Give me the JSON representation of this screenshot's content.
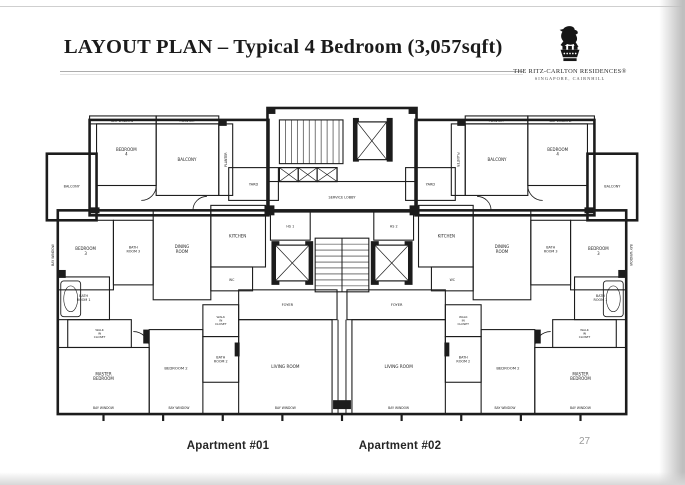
{
  "slide": {
    "title": "LAYOUT PLAN – Typical 4 Bedroom (3,057sqft)",
    "page_number": "27",
    "captions": {
      "apartment1": "Apartment #01",
      "apartment2": "Apartment #02"
    },
    "brand": {
      "logo_icon": "lion-crest",
      "name_display": "THE RITZ-CARLTON RESIDENCES®",
      "location": "SINGAPORE, CAIRNHILL"
    }
  },
  "floorplan": {
    "ink": "#1c1c1c",
    "label_color": "#1d1d1d",
    "rooms": [
      {
        "id": "bay-strip-l",
        "x": 46,
        "y": 10,
        "w": 67,
        "h": 8
      },
      {
        "id": "planter-strip-l",
        "x": 113,
        "y": 10,
        "w": 63,
        "h": 8
      },
      {
        "id": "bedroom4-l",
        "x": 53,
        "y": 18,
        "w": 60,
        "h": 62
      },
      {
        "id": "balcony-top-l",
        "x": 113,
        "y": 18,
        "w": 63,
        "h": 72
      },
      {
        "id": "planter-col-l",
        "x": 176,
        "y": 18,
        "w": 14,
        "h": 72
      },
      {
        "id": "balcony-left",
        "x": 3,
        "y": 48,
        "w": 50,
        "h": 67
      },
      {
        "id": "yard-l",
        "x": 186,
        "y": 62,
        "w": 50,
        "h": 33
      },
      {
        "id": "kitchen-l",
        "x": 168,
        "y": 100,
        "w": 55,
        "h": 62
      },
      {
        "id": "wc-l",
        "x": 168,
        "y": 162,
        "w": 42,
        "h": 24
      },
      {
        "id": "hs-1",
        "x": 228,
        "y": 105,
        "w": 40,
        "h": 30
      },
      {
        "id": "dining-l",
        "x": 110,
        "y": 105,
        "w": 58,
        "h": 90
      },
      {
        "id": "bedroom3-l",
        "x": 14,
        "y": 115,
        "w": 56,
        "h": 70
      },
      {
        "id": "bath3-l",
        "x": 70,
        "y": 115,
        "w": 40,
        "h": 65
      },
      {
        "id": "bath1-l",
        "x": 14,
        "y": 172,
        "w": 52,
        "h": 43
      },
      {
        "id": "wic1-l",
        "x": 24,
        "y": 215,
        "w": 64,
        "h": 28
      },
      {
        "id": "master-l",
        "x": 14,
        "y": 243,
        "w": 92,
        "h": 67
      },
      {
        "id": "bedroom2-l",
        "x": 106,
        "y": 225,
        "w": 54,
        "h": 85
      },
      {
        "id": "wic2-l",
        "x": 160,
        "y": 200,
        "w": 36,
        "h": 32
      },
      {
        "id": "bath2-l",
        "x": 160,
        "y": 232,
        "w": 36,
        "h": 46
      },
      {
        "id": "foyer-l",
        "x": 196,
        "y": 185,
        "w": 99,
        "h": 30
      },
      {
        "id": "living-l",
        "x": 196,
        "y": 215,
        "w": 94,
        "h": 95
      },
      {
        "id": "bay-strip-r",
        "x": 487,
        "y": 10,
        "w": 67,
        "h": 8
      },
      {
        "id": "planter-strip-r",
        "x": 424,
        "y": 10,
        "w": 63,
        "h": 8
      },
      {
        "id": "bedroom4-r",
        "x": 487,
        "y": 18,
        "w": 60,
        "h": 62
      },
      {
        "id": "balcony-top-r",
        "x": 424,
        "y": 18,
        "w": 63,
        "h": 72
      },
      {
        "id": "planter-col-r",
        "x": 410,
        "y": 18,
        "w": 14,
        "h": 72
      },
      {
        "id": "balcony-right",
        "x": 547,
        "y": 48,
        "w": 50,
        "h": 67
      },
      {
        "id": "yard-r",
        "x": 364,
        "y": 62,
        "w": 50,
        "h": 33
      },
      {
        "id": "kitchen-r",
        "x": 377,
        "y": 100,
        "w": 55,
        "h": 62
      },
      {
        "id": "wc-r",
        "x": 390,
        "y": 162,
        "w": 42,
        "h": 24
      },
      {
        "id": "hs-2",
        "x": 332,
        "y": 105,
        "w": 40,
        "h": 30
      },
      {
        "id": "dining-r",
        "x": 432,
        "y": 105,
        "w": 58,
        "h": 90
      },
      {
        "id": "bedroom3-r",
        "x": 530,
        "y": 115,
        "w": 56,
        "h": 70
      },
      {
        "id": "bath3-r",
        "x": 490,
        "y": 115,
        "w": 40,
        "h": 65
      },
      {
        "id": "bath1-r",
        "x": 534,
        "y": 172,
        "w": 52,
        "h": 43
      },
      {
        "id": "wic1-r",
        "x": 512,
        "y": 215,
        "w": 64,
        "h": 28
      },
      {
        "id": "master-r",
        "x": 494,
        "y": 243,
        "w": 92,
        "h": 67
      },
      {
        "id": "bedroom2-r",
        "x": 440,
        "y": 225,
        "w": 54,
        "h": 85
      },
      {
        "id": "wic2-r",
        "x": 404,
        "y": 200,
        "w": 36,
        "h": 32
      },
      {
        "id": "bath2-r",
        "x": 404,
        "y": 232,
        "w": 36,
        "h": 46
      },
      {
        "id": "foyer-r",
        "x": 305,
        "y": 185,
        "w": 99,
        "h": 30
      },
      {
        "id": "living-r",
        "x": 310,
        "y": 215,
        "w": 94,
        "h": 95
      },
      {
        "id": "stairs-top",
        "x": 237,
        "y": 14,
        "w": 64,
        "h": 44
      },
      {
        "id": "risers",
        "x": 237,
        "y": 62,
        "w": 58,
        "h": 14
      },
      {
        "id": "service-lobby",
        "x": 225,
        "y": 76,
        "w": 150,
        "h": 30
      },
      {
        "id": "stairwell",
        "x": 273,
        "y": 133,
        "w": 54,
        "h": 54
      }
    ],
    "outlines": [
      [
        14,
        105,
        572,
        205
      ],
      [
        46,
        14,
        180,
        96
      ],
      [
        374,
        14,
        180,
        96
      ],
      [
        225,
        2,
        150,
        104
      ],
      [
        3,
        48,
        50,
        67
      ],
      [
        547,
        48,
        50,
        67
      ]
    ],
    "lines": [
      [
        296,
        215,
        296,
        310
      ],
      [
        304,
        215,
        304,
        310
      ],
      [
        300,
        133,
        300,
        187
      ],
      [
        225,
        106,
        375,
        106
      ]
    ],
    "blacks": [
      [
        229,
        136,
        8,
        44
      ],
      [
        263,
        136,
        8,
        44
      ],
      [
        329,
        136,
        8,
        44
      ],
      [
        363,
        136,
        8,
        44
      ],
      [
        311,
        12,
        6,
        44
      ],
      [
        345,
        12,
        6,
        44
      ],
      [
        291,
        296,
        18,
        9
      ],
      [
        225,
        2,
        8,
        6
      ],
      [
        367,
        2,
        8,
        6
      ],
      [
        222,
        100,
        10,
        10
      ],
      [
        368,
        100,
        10,
        10
      ],
      [
        14,
        165,
        8,
        8
      ],
      [
        578,
        165,
        8,
        8
      ],
      [
        100,
        225,
        6,
        14
      ],
      [
        494,
        225,
        6,
        14
      ],
      [
        192,
        238,
        5,
        14
      ],
      [
        403,
        238,
        5,
        14
      ],
      [
        46,
        102,
        10,
        6
      ],
      [
        544,
        102,
        10,
        6
      ],
      [
        176,
        14,
        8,
        6
      ],
      [
        416,
        14,
        8,
        6
      ]
    ],
    "xboxes": [
      [
        315,
        16,
        30,
        38
      ],
      [
        233,
        140,
        34,
        36
      ],
      [
        333,
        140,
        34,
        36
      ],
      [
        237,
        62,
        19,
        14
      ],
      [
        256,
        62,
        19,
        14
      ],
      [
        275,
        62,
        20,
        14
      ]
    ],
    "stairs": [
      {
        "x": 237,
        "y": 14,
        "w": 64,
        "h": 44,
        "dir": "v",
        "step": 6
      },
      {
        "x": 273,
        "y": 133,
        "w": 54,
        "h": 54,
        "dir": "h",
        "step": 6
      }
    ],
    "tubs": [
      [
        17,
        176,
        20,
        36
      ],
      [
        563,
        176,
        20,
        36
      ]
    ],
    "arcs": [
      "M113,80 a15,15 0 0 1 -15,15",
      "M487,80 a15,15 0 0 0 15,15",
      "M106,243 a16,16 0 0 0 -16,-16",
      "M494,243 a16,16 0 0 1 16,-16",
      "M150,105 a14,14 0 0 1 14,-14",
      "M450,105 a14,14 0 0 0 -14,-14"
    ],
    "ticks": [
      60,
      120,
      180,
      240,
      300,
      360,
      420,
      480,
      540
    ],
    "labels": [
      {
        "t": "BAY WINDOW",
        "x": 79,
        "y": 15,
        "s": 3.3
      },
      {
        "t": "PLANTER",
        "x": 144,
        "y": 15,
        "s": 3.3
      },
      {
        "t": "BEDROOM\n4",
        "x": 83,
        "y": 46,
        "s": 4
      },
      {
        "t": "BALCONY",
        "x": 144,
        "y": 54,
        "s": 4
      },
      {
        "t": "PLANTER",
        "x": 183,
        "y": 54,
        "s": 3.2,
        "r": -90
      },
      {
        "t": "BALCONY",
        "x": 28,
        "y": 81,
        "s": 3.4
      },
      {
        "t": "BAY WINDOW",
        "x": 9,
        "y": 150,
        "s": 3.2,
        "r": -90
      },
      {
        "t": "YARD",
        "x": 211,
        "y": 79,
        "s": 3.5
      },
      {
        "t": "KITCHEN",
        "x": 195,
        "y": 131,
        "s": 4
      },
      {
        "t": "WC",
        "x": 189,
        "y": 175,
        "s": 3.2
      },
      {
        "t": "HS 1",
        "x": 248,
        "y": 121,
        "s": 3.4
      },
      {
        "t": "DINING\nROOM",
        "x": 139,
        "y": 144,
        "s": 4
      },
      {
        "t": "BEDROOM\n3",
        "x": 42,
        "y": 146,
        "s": 4
      },
      {
        "t": "BATH\nROOM 3",
        "x": 90,
        "y": 144,
        "s": 3.4
      },
      {
        "t": "BATH\nROOM 1",
        "x": 40,
        "y": 193,
        "s": 3.4
      },
      {
        "t": "WALK\nIN\nCLOSET",
        "x": 56,
        "y": 229,
        "s": 3
      },
      {
        "t": "MASTER\nBEDROOM",
        "x": 60,
        "y": 272,
        "s": 4
      },
      {
        "t": "BEDROOM 2",
        "x": 133,
        "y": 264,
        "s": 3.8
      },
      {
        "t": "WALK\nIN\nCLOSET",
        "x": 178,
        "y": 216,
        "s": 3
      },
      {
        "t": "BATH\nROOM 2",
        "x": 178,
        "y": 255,
        "s": 3.4
      },
      {
        "t": "FOYER",
        "x": 245,
        "y": 200,
        "s": 3.6
      },
      {
        "t": "LIVING ROOM",
        "x": 243,
        "y": 262,
        "s": 4.2
      },
      {
        "t": "SERVICE LOBBY",
        "x": 300,
        "y": 92,
        "s": 3.5
      },
      {
        "t": "BAY WINDOW",
        "x": 520,
        "y": 15,
        "s": 3.3
      },
      {
        "t": "PLANTER",
        "x": 455,
        "y": 15,
        "s": 3.3
      },
      {
        "t": "BEDROOM\n4",
        "x": 517,
        "y": 46,
        "s": 4
      },
      {
        "t": "BALCONY",
        "x": 456,
        "y": 54,
        "s": 4
      },
      {
        "t": "PLANTER",
        "x": 417,
        "y": 54,
        "s": 3.2,
        "r": 90
      },
      {
        "t": "BALCONY",
        "x": 572,
        "y": 81,
        "s": 3.4
      },
      {
        "t": "BAY WINDOW",
        "x": 591,
        "y": 150,
        "s": 3.2,
        "r": 90
      },
      {
        "t": "YARD",
        "x": 389,
        "y": 79,
        "s": 3.5
      },
      {
        "t": "KITCHEN",
        "x": 405,
        "y": 131,
        "s": 4
      },
      {
        "t": "WC",
        "x": 411,
        "y": 175,
        "s": 3.2
      },
      {
        "t": "HS 2",
        "x": 352,
        "y": 121,
        "s": 3.4
      },
      {
        "t": "DINING\nROOM",
        "x": 461,
        "y": 144,
        "s": 4
      },
      {
        "t": "BEDROOM\n3",
        "x": 558,
        "y": 146,
        "s": 4
      },
      {
        "t": "BATH\nROOM 3",
        "x": 510,
        "y": 144,
        "s": 3.4
      },
      {
        "t": "BATH\nROOM 1",
        "x": 560,
        "y": 193,
        "s": 3.4
      },
      {
        "t": "WALK\nIN\nCLOSET",
        "x": 544,
        "y": 229,
        "s": 3
      },
      {
        "t": "MASTER\nBEDROOM",
        "x": 540,
        "y": 272,
        "s": 4
      },
      {
        "t": "BEDROOM 2",
        "x": 467,
        "y": 264,
        "s": 3.8
      },
      {
        "t": "WALK\nIN\nCLOSET",
        "x": 422,
        "y": 216,
        "s": 3
      },
      {
        "t": "BATH\nROOM 2",
        "x": 422,
        "y": 255,
        "s": 3.4
      },
      {
        "t": "FOYER",
        "x": 355,
        "y": 200,
        "s": 3.6
      },
      {
        "t": "LIVING ROOM",
        "x": 357,
        "y": 262,
        "s": 4.2
      },
      {
        "t": "BAY WINDOW",
        "x": 60,
        "y": 304,
        "s": 3.1
      },
      {
        "t": "BAY WINDOW",
        "x": 136,
        "y": 304,
        "s": 3.1
      },
      {
        "t": "BAY WINDOW",
        "x": 243,
        "y": 304,
        "s": 3.1
      },
      {
        "t": "BAY WINDOW",
        "x": 357,
        "y": 304,
        "s": 3.1
      },
      {
        "t": "BAY WINDOW",
        "x": 464,
        "y": 304,
        "s": 3.1
      },
      {
        "t": "BAY WINDOW",
        "x": 540,
        "y": 304,
        "s": 3.1
      }
    ]
  }
}
